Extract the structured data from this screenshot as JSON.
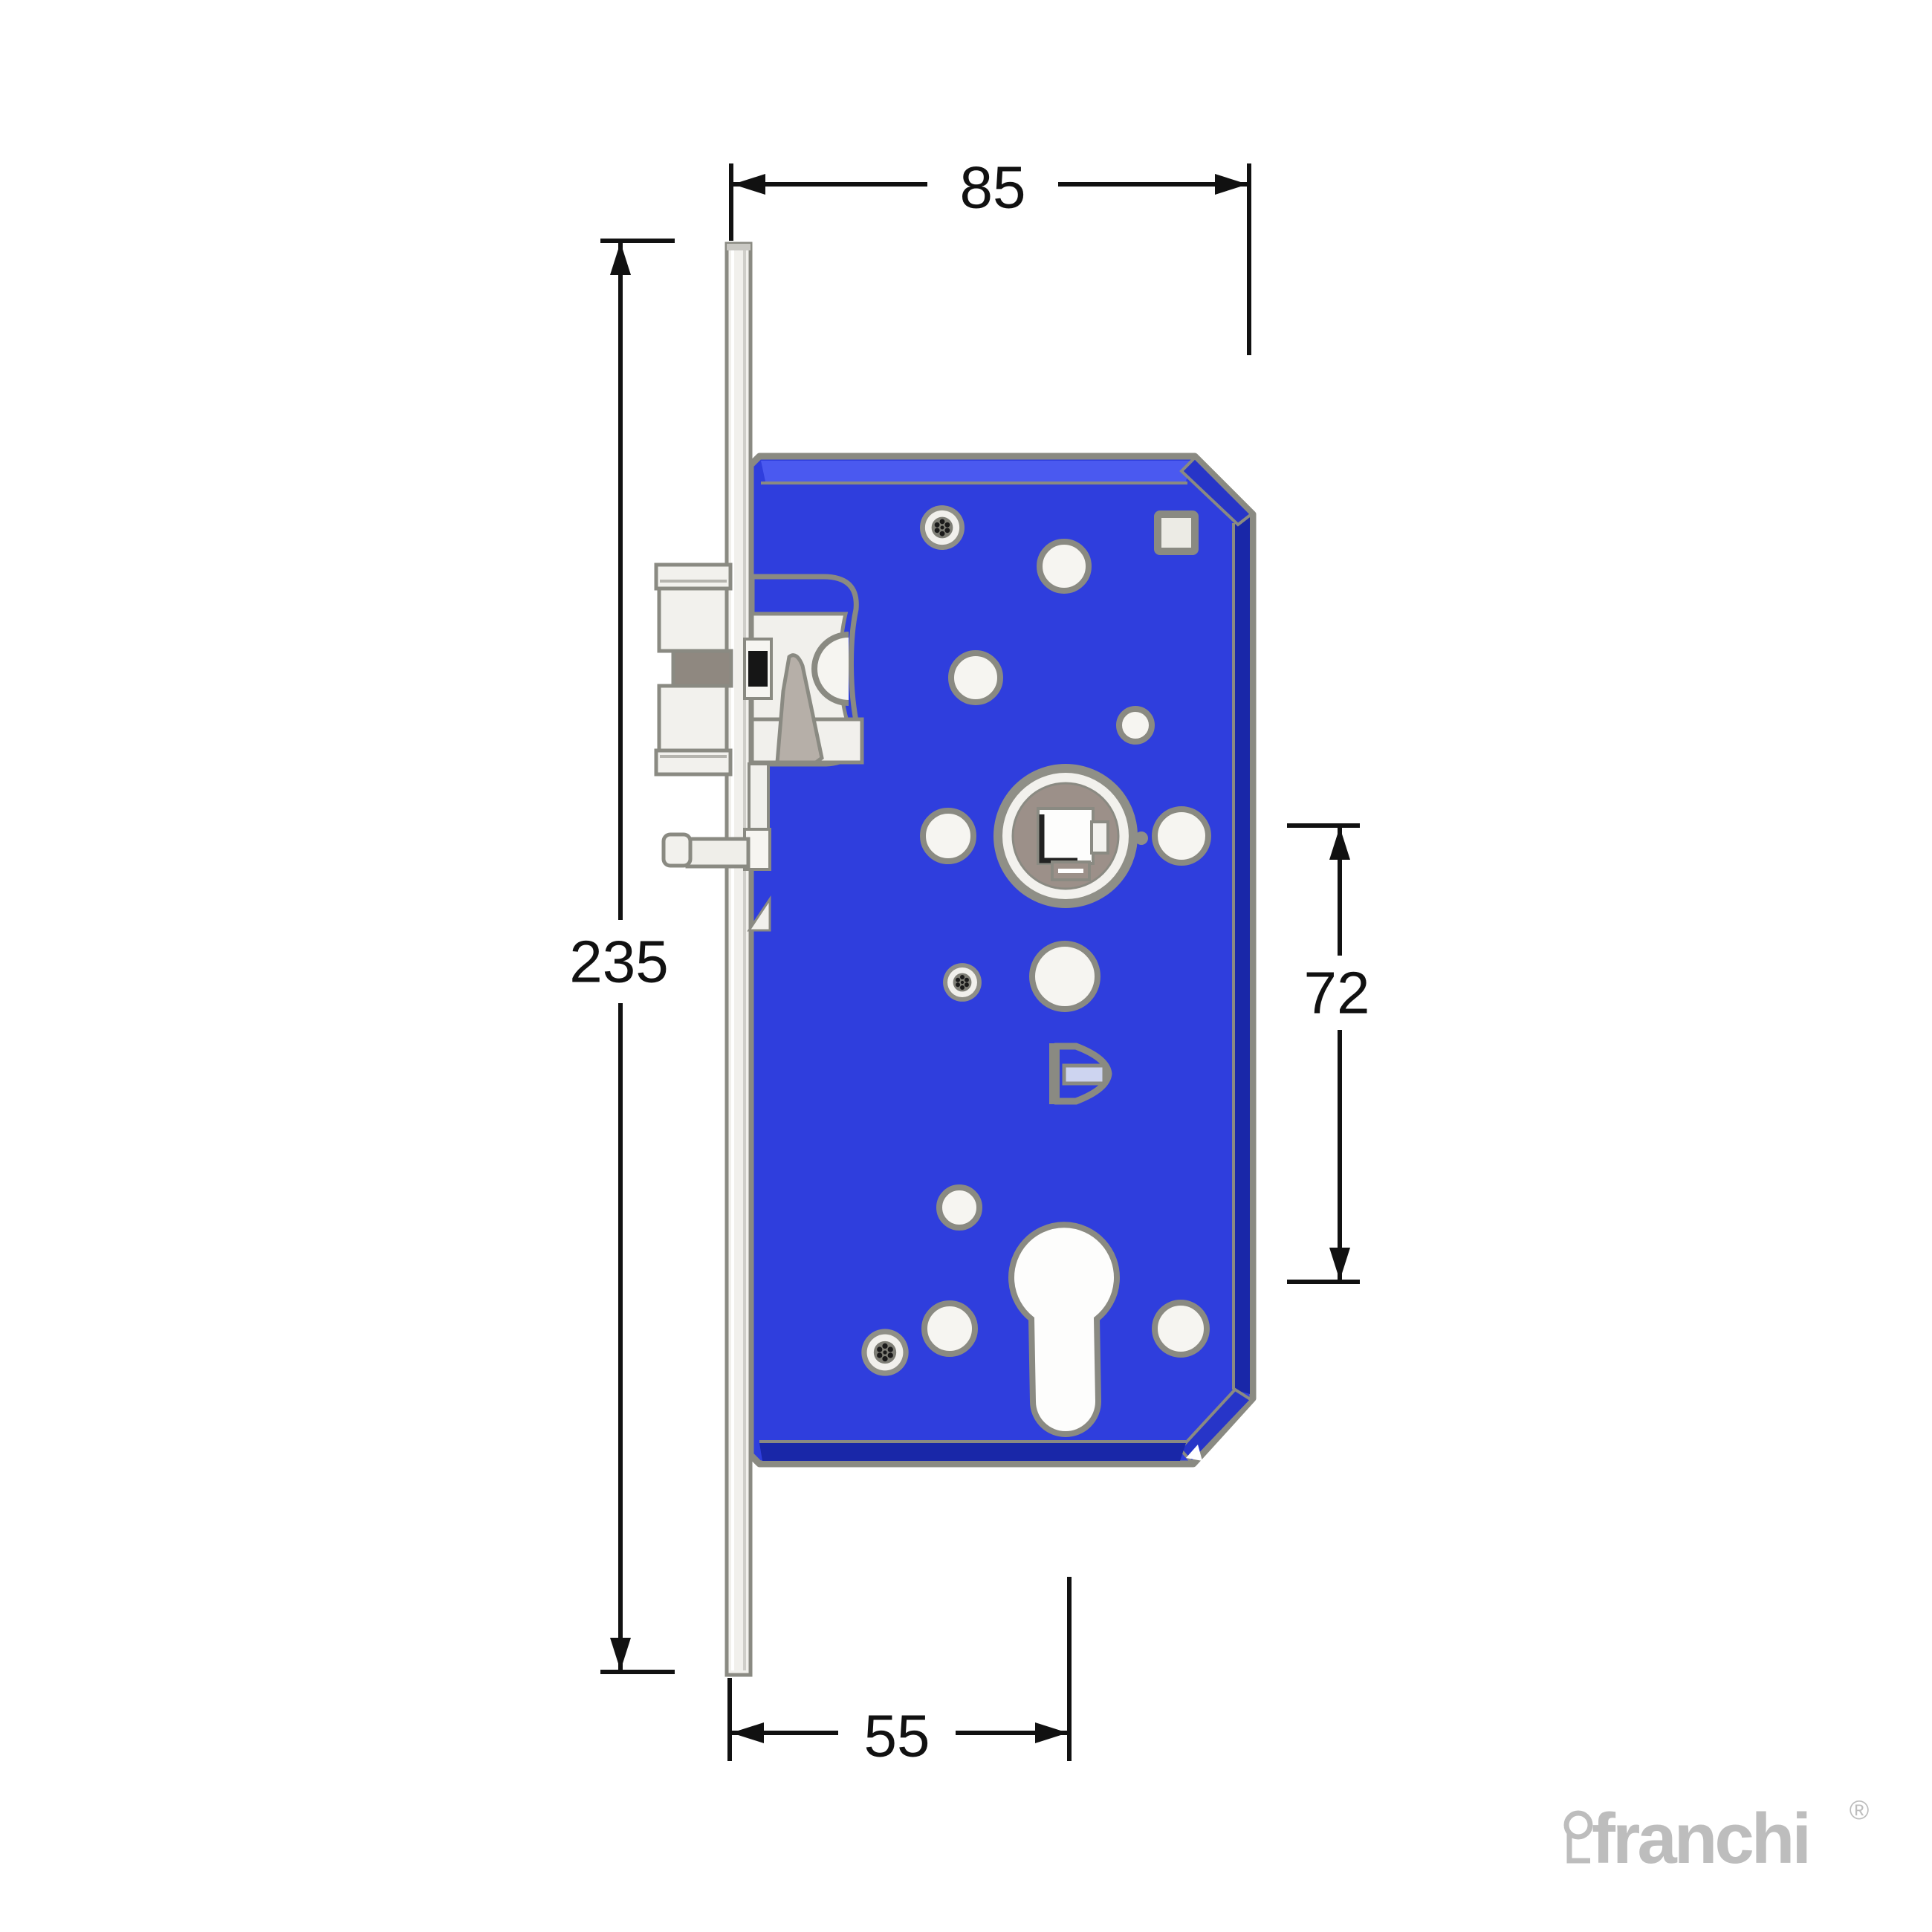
{
  "drawing": {
    "product": "mortise-lock-case-side-elevation",
    "dims": {
      "case_depth_mm": "85",
      "faceplate_height_mm": "235",
      "centres_mm": "72",
      "backset_mm": "55"
    },
    "logo": {
      "brand": "franchi",
      "registered_mark": "®"
    },
    "colors": {
      "body_blue": "#2F3EDD",
      "body_blue_dark": "#1927A8",
      "body_blue_mid": "#2735C8",
      "body_blue_light": "#4A59F0",
      "outline_gray": "#8A8A82",
      "metal_ivory": "#F1F0EC",
      "metal_white": "#FDFDFC",
      "follower_taupe": "#9C9089",
      "wedge_gray": "#B6AFA8",
      "bar_gray": "#8F8880",
      "clip_lavender": "#CDD4F0",
      "dimension_black": "#111111",
      "logo_gray": "#BDBDBD"
    }
  }
}
